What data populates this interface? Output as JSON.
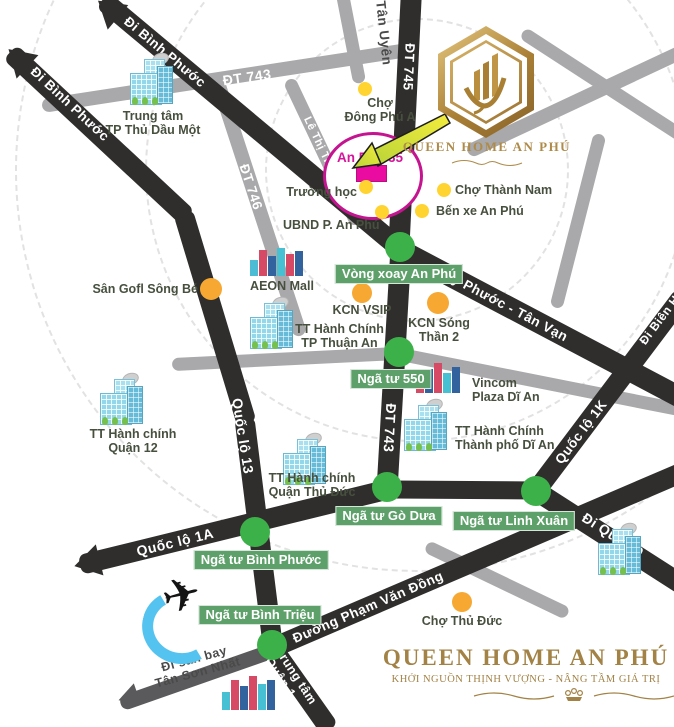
{
  "colors": {
    "road_black": "#2F2E2D",
    "road_gray": "#A9A9AB",
    "road_dark_gray": "#5A5A5C",
    "green_circle": "#3CB14A",
    "green_tag_bg": "#5EA06A",
    "yellow_dot": "#FFD430",
    "orange_dot": "#F6A832",
    "magenta": "#D6159B",
    "gold": "#AE8B49",
    "label_text": "#47503E"
  },
  "site": {
    "name": "An Phú 35"
  },
  "logo": {
    "title": "QUEEN HOME AN PHÚ"
  },
  "footer": {
    "title": "QUEEN HOME AN PHÚ",
    "tagline": "KHỞI NGUỒN THỊNH VƯỢNG - NÂNG TẦM GIÁ TRỊ"
  },
  "roads": {
    "di_binh_phuoc_upper": "Đi Bình Phước",
    "di_binh_phuoc_lower": "Đi Bình Phước",
    "dt_745": "ĐT 745",
    "tan_uyen": "Tân Uyên",
    "dt_743_top": "ĐT 743",
    "dt_747": "ĐT 747",
    "le_thi_trung": "Lê Thị Trung",
    "dt_746": "ĐT 746",
    "quoc_lo_13": "Quốc lộ 13",
    "my_phuoc_tan_van": "Mỹ Phước - Tân Vạn",
    "dt_743_mid": "ĐT 743",
    "quoc_lo_1k": "Quốc lộ 1K",
    "di_bien_hoa": "Đi Biên Hòa",
    "quoc_lo_1a": "Quốc lộ 1A",
    "di_quan_9": "Đi Quận 9",
    "pham_van_dong": "Đường Phạm Văn Đồng",
    "di_san_bay": "Đi sân bay\nTân Sơn Nhất",
    "di_trung_tam": "Đi trung tâm\nQuận 1"
  },
  "intersections": [
    {
      "name": "Vòng xoay An Phú"
    },
    {
      "name": "Ngã tư 550"
    },
    {
      "name": "Ngã tư Gò Dưa"
    },
    {
      "name": "Ngã tư Linh Xuân"
    },
    {
      "name": "Ngã tư Bình Phước"
    },
    {
      "name": "Ngã tư Bình Triệu"
    }
  ],
  "places": [
    {
      "name": "Chợ\nĐông Phú A",
      "type": "market"
    },
    {
      "name": "Chợ Thành Nam",
      "type": "market"
    },
    {
      "name": "Bến xe An Phú",
      "type": "bus-station"
    },
    {
      "name": "Trường học",
      "type": "school"
    },
    {
      "name": "UBND P. An Phú",
      "type": "government"
    },
    {
      "name": "Sân Gofl Sông Bé",
      "type": "golf"
    },
    {
      "name": "KCN VSIP",
      "type": "industrial"
    },
    {
      "name": "KCN Sóng\nThần 2",
      "type": "industrial"
    },
    {
      "name": "Chợ Thủ Đức",
      "type": "market"
    }
  ],
  "buildings": [
    {
      "name": "Trung tâm\nTP Thủ Dầu Một"
    },
    {
      "name": "AEON Mall"
    },
    {
      "name": "TT Hành Chính\nTP Thuận An"
    },
    {
      "name": "TT Hành chính\nQuận 12"
    },
    {
      "name": "Vincom\nPlaza Dĩ An"
    },
    {
      "name": "TT Hành Chính\nThành phố Dĩ An"
    },
    {
      "name": "TT Hành chính\nQuận Thủ Đức"
    }
  ]
}
